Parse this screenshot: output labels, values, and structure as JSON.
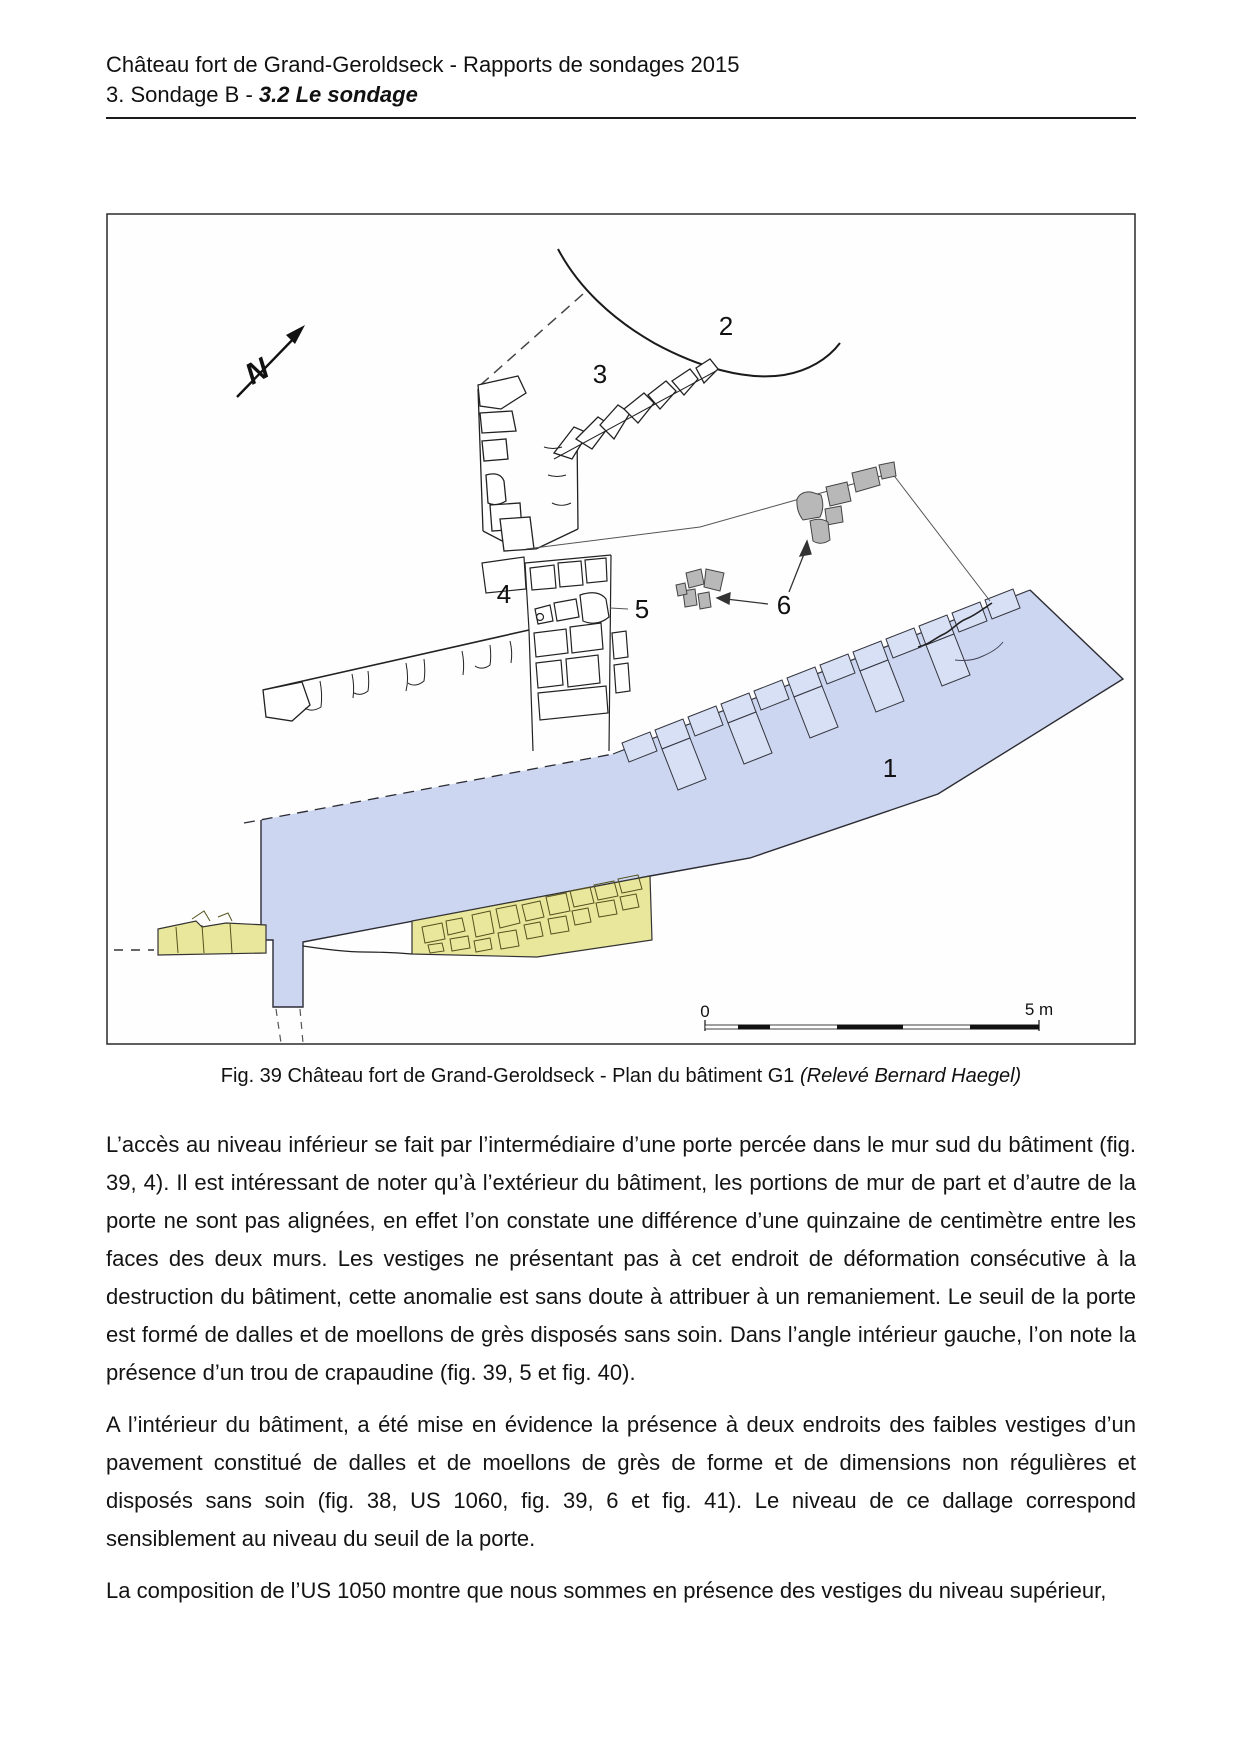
{
  "header": {
    "line1": "Château fort de Grand-Geroldseck - Rapports de sondages 2015",
    "line2_prefix": "3. Sondage B - ",
    "line2_emphasis": "3.2 Le sondage"
  },
  "figure": {
    "caption_main": "Fig. 39 Château fort de Grand-Geroldseck - Plan du bâtiment G1 ",
    "caption_italic": "(Relevé Bernard Haegel)",
    "north_letter": "N",
    "labels": {
      "n1": "1",
      "n2": "2",
      "n3": "3",
      "n4": "4",
      "n5": "5",
      "n6": "6"
    },
    "scale_bar": {
      "start": "0",
      "end": "5 m"
    },
    "colors": {
      "wall_highlight_blue": "#ccd6f0",
      "wall_stone_blue": "#d8e0f6",
      "pavement_yellow": "#e9e79c",
      "stone_gray": "#b8b8b8"
    }
  },
  "body": {
    "p1": "L’accès au niveau inférieur se fait par l’intermédiaire d’une porte percée dans le mur sud du bâtiment (fig. 39, 4). Il est intéressant de noter qu’à l’extérieur du bâtiment, les portions de mur de part et d’autre de la porte ne sont pas alignées, en effet l’on constate une différence d’une quinzaine de centimètre entre les faces des deux murs. Les vestiges ne présentant pas à cet endroit de déformation consécutive à la destruction du bâtiment, cette anomalie est sans doute à attribuer à un remaniement. Le seuil de la porte est formé de dalles et de moellons de grès disposés sans soin. Dans l’angle intérieur gauche, l’on note la présence d’un trou de crapaudine  (fig. 39, 5 et fig. 40).",
    "p2": "A l’intérieur du bâtiment, a été mise en évidence la présence à deux endroits des faibles vestiges d’un pavement constitué de dalles et de moellons de grès de forme et de dimensions non régulières et disposés sans soin (fig. 38, US 1060, fig. 39, 6 et fig. 41). Le niveau de ce dallage correspond sensiblement au niveau du seuil de la porte.",
    "p3": "La composition de l’US 1050 montre que nous sommes en présence des vestiges du niveau supérieur,"
  }
}
